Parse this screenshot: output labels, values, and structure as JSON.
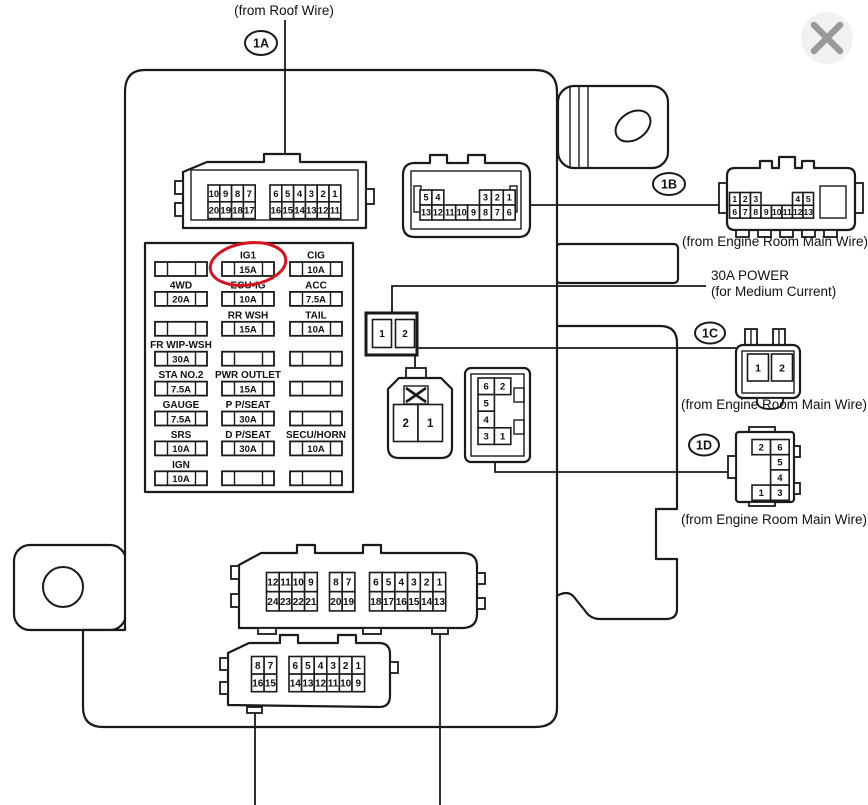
{
  "window": {
    "close_icon": "x"
  },
  "labels": {
    "roof_wire": "(from Roof Wire)",
    "engine_room_1b": "(from Engine Room Main Wire)",
    "engine_room_1c": "(from Engine Room Main Wire)",
    "engine_room_1d": "(from Engine Room Main Wire)",
    "power_line1": "30A POWER",
    "power_line2": "(for Medium Current)"
  },
  "callouts": {
    "c1a": "1A",
    "c1b": "1B",
    "c1c": "1C",
    "c1d": "1D"
  },
  "pin_connectors": {
    "roof_1a": {
      "groups": [
        [
          [
            "10",
            "9",
            "8",
            "7"
          ],
          [
            "20",
            "19",
            "18",
            "17"
          ]
        ],
        [
          [
            "6",
            "5",
            "4",
            "3",
            "2",
            "1"
          ],
          [
            "16",
            "15",
            "14",
            "13",
            "12",
            "11"
          ]
        ]
      ]
    },
    "block_1b_socket": {
      "groups": [
        [
          [
            "5",
            "4",
            "",
            "",
            "",
            "3",
            "2",
            "1"
          ],
          [
            "13",
            "12",
            "11",
            "10",
            "9",
            "8",
            "7",
            "6"
          ]
        ]
      ]
    },
    "engine_1b_plug": {
      "groups": [
        [
          [
            "1",
            "2",
            "3",
            "",
            "",
            "",
            "4",
            "5"
          ],
          [
            "6",
            "7",
            "8",
            "9",
            "10",
            "11",
            "12",
            "13"
          ]
        ]
      ]
    },
    "power_socket": {
      "groups": [
        [
          [
            "1",
            "2"
          ]
        ]
      ]
    },
    "power_plug": {
      "groups": [
        [
          [
            "2",
            "1"
          ]
        ]
      ]
    },
    "block_socket_6pin": {
      "groups": [
        [
          [
            "6",
            "2"
          ],
          [
            "5",
            ""
          ],
          [
            "4",
            ""
          ],
          [
            "3",
            "1"
          ]
        ]
      ]
    },
    "engine_1c_plug": {
      "groups": [
        [
          [
            "1",
            "2"
          ]
        ]
      ]
    },
    "engine_1d_plug": {
      "groups": [
        [
          [
            "2",
            "6"
          ],
          [
            "",
            "5"
          ],
          [
            "",
            "4"
          ],
          [
            "1",
            "3"
          ]
        ]
      ]
    },
    "bottom_large": {
      "groups": [
        [
          [
            "12",
            "11",
            "10",
            "9"
          ],
          [
            "24",
            "23",
            "22",
            "21"
          ]
        ],
        [
          [
            "8",
            "7"
          ],
          [
            "20",
            "19"
          ]
        ],
        [
          [
            "6",
            "5",
            "4",
            "3",
            "2",
            "1"
          ],
          [
            "18",
            "17",
            "16",
            "15",
            "14",
            "13"
          ]
        ]
      ]
    },
    "bottom_small": {
      "groups": [
        [
          [
            "8",
            "7"
          ],
          [
            "16",
            "15"
          ]
        ],
        [
          [
            "6",
            "5",
            "4",
            "3",
            "2",
            "1"
          ],
          [
            "14",
            "13",
            "12",
            "11",
            "10",
            "9"
          ]
        ]
      ]
    }
  },
  "fuse_panel": {
    "highlight_color": "#d8121c",
    "rows": [
      [
        null,
        {
          "label": "IG1",
          "amp": "15A",
          "highlight": true
        },
        {
          "label": "CIG",
          "amp": "10A"
        }
      ],
      [
        {
          "label": "4WD",
          "amp": "20A"
        },
        {
          "label": "ECU-IG",
          "amp": "10A"
        },
        {
          "label": "ACC",
          "amp": "7.5A"
        }
      ],
      [
        null,
        {
          "label": "RR WSH",
          "amp": "15A"
        },
        {
          "label": "TAIL",
          "amp": "10A"
        }
      ],
      [
        {
          "label": "FR WIP-WSH",
          "amp": "30A"
        },
        null,
        null
      ],
      [
        {
          "label": "STA NO.2",
          "amp": "7.5A"
        },
        {
          "label": "PWR OUTLET",
          "amp": "15A"
        },
        null
      ],
      [
        {
          "label": "GAUGE",
          "amp": "7.5A"
        },
        {
          "label": "P P/SEAT",
          "amp": "30A"
        },
        null
      ],
      [
        {
          "label": "SRS",
          "amp": "10A"
        },
        {
          "label": "D P/SEAT",
          "amp": "30A"
        },
        {
          "label": "SECU/HORN",
          "amp": "10A"
        }
      ],
      [
        {
          "label": "IGN",
          "amp": "10A"
        },
        null,
        null
      ]
    ]
  }
}
